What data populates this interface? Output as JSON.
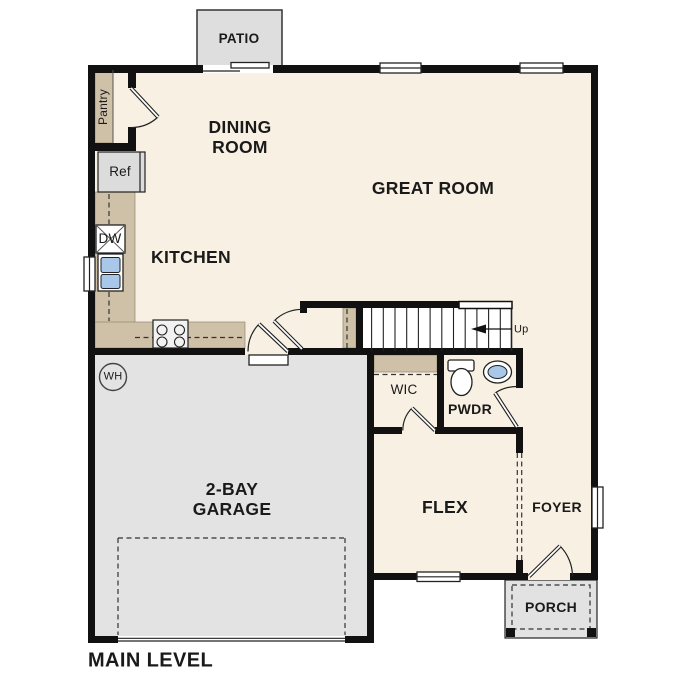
{
  "title": {
    "text": "MAIN LEVEL"
  },
  "colors": {
    "wall": "#111111",
    "floor": "#f8f0e3",
    "garage-floor": "#e3e3e3",
    "patio-floor": "#dedede",
    "porch-floor": "#e2e2e2",
    "cabinet-tan": "#cfc1a8",
    "fixture-blue": "#a9c7e8",
    "appliance-gray": "#dcdcdc",
    "label": "#1a1a1a"
  },
  "rooms": {
    "patio": {
      "label": "PATIO"
    },
    "dining_room": {
      "label": "DINING\nROOM"
    },
    "great_room": {
      "label": "GREAT ROOM"
    },
    "kitchen": {
      "label": "KITCHEN"
    },
    "garage": {
      "label": "2-BAY\nGARAGE"
    },
    "wic": {
      "label": "WIC"
    },
    "pwdr": {
      "label": "PWDR"
    },
    "flex": {
      "label": "FLEX"
    },
    "foyer": {
      "label": "FOYER"
    },
    "porch": {
      "label": "PORCH"
    }
  },
  "fixtures": {
    "pantry": {
      "label": "Pantry"
    },
    "refrigerator": {
      "label": "Ref"
    },
    "dishwasher": {
      "label": "DW"
    },
    "water_heater": {
      "label": "WH"
    }
  },
  "stairs": {
    "direction_label": "Up"
  }
}
